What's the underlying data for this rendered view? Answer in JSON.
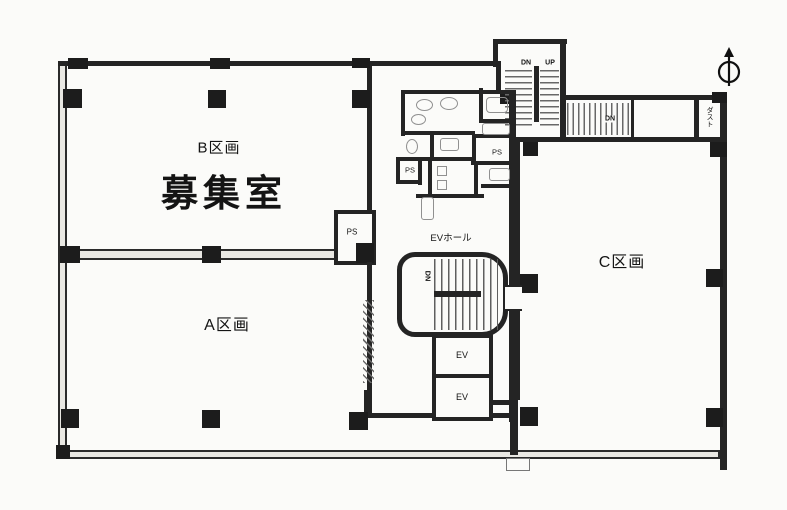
{
  "plan": {
    "sections": {
      "b_label": "B区画",
      "recruit_label": "募集室",
      "a_label": "A区画",
      "c_label": "C区画"
    },
    "core": {
      "ev_hall_label": "EVホール",
      "ev_label": "EV",
      "ps_label": "PS",
      "dust_label": "ダスト"
    },
    "stairs": {
      "dn_label": "DN",
      "up_label": "UP"
    },
    "colors": {
      "wall": "#242424",
      "paper": "#fbfbf9",
      "fixture": "#909090"
    }
  }
}
